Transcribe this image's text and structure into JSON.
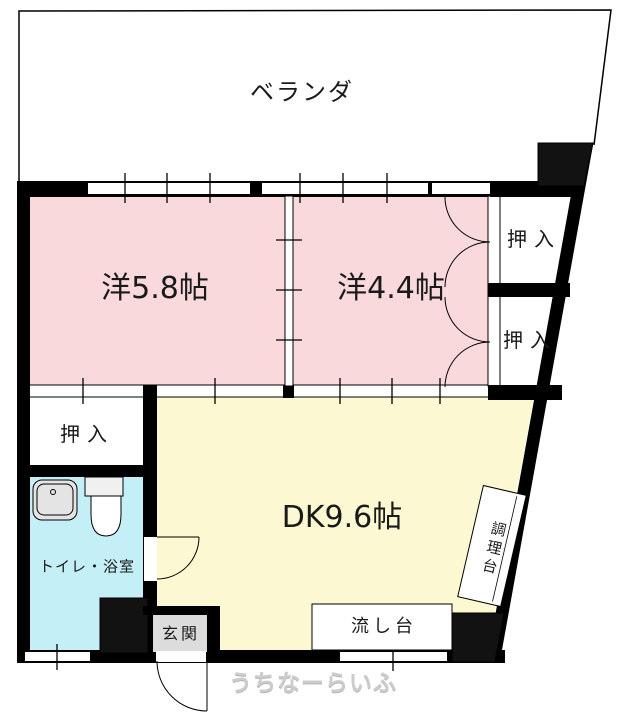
{
  "plan": {
    "veranda": {
      "label": "ベランダ"
    },
    "western_room_large": {
      "label": "洋5.8帖"
    },
    "western_room_small": {
      "label": "洋4.4帖"
    },
    "closet_right_top": {
      "label": "押入"
    },
    "closet_right_bottom": {
      "label": "押入"
    },
    "closet_left": {
      "label": "押入"
    },
    "bathroom": {
      "label": "トイレ・浴室"
    },
    "dining_kitchen": {
      "label": "DK9.6帖"
    },
    "entrance": {
      "label": "玄関"
    },
    "sink_counter": {
      "label": "流し台"
    },
    "cooking_counter": {
      "label": "調理台"
    }
  },
  "watermark": {
    "text": "うちなーらいふ"
  },
  "colors": {
    "room_pink": "#f9d9db",
    "dk_yellow": "#fbf8d2",
    "bath_cyan": "#c5eff7",
    "entrance_gray": "#dcdcdc",
    "wall_black": "#000000",
    "pillar_dark": "#121212",
    "watermark_gray": "#cccccc"
  }
}
